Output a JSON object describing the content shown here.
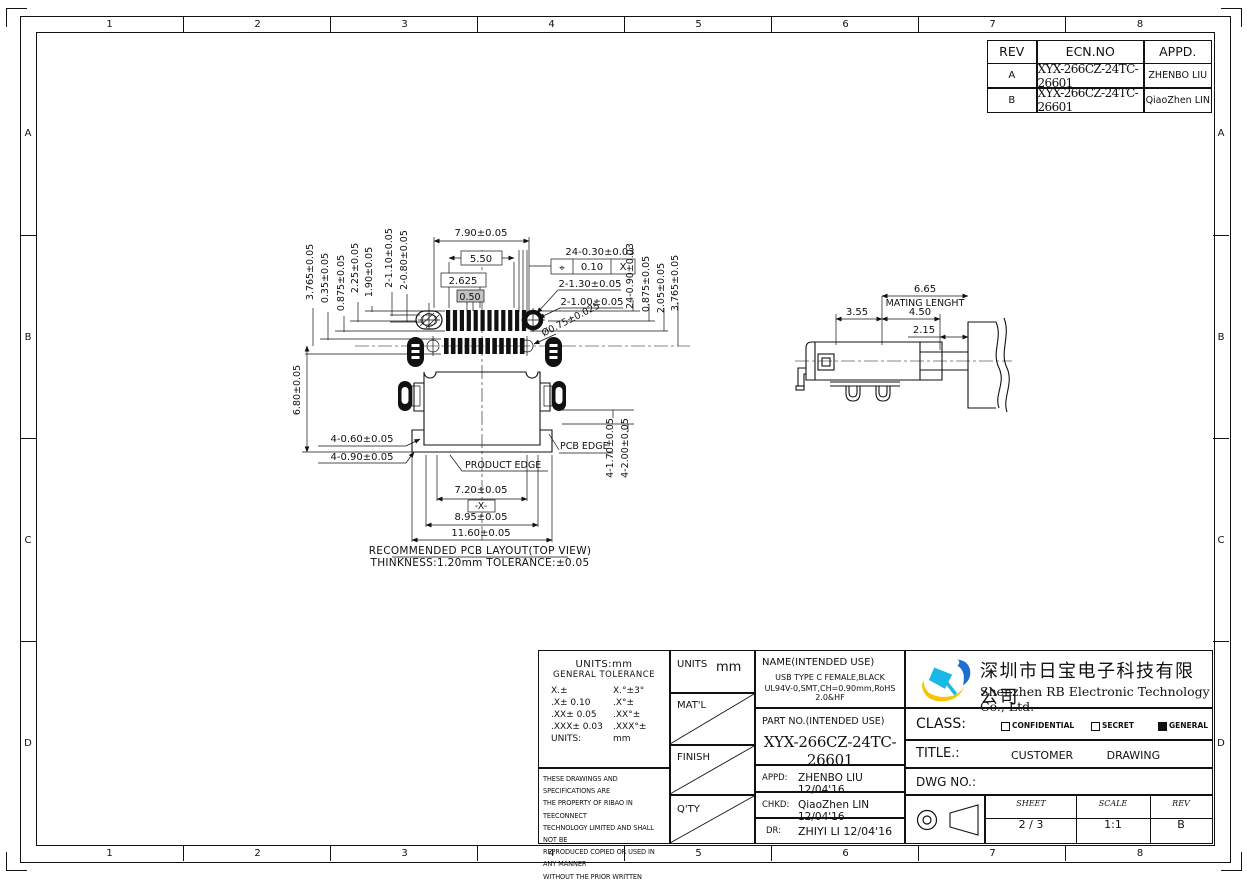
{
  "colors": {
    "line": "#111111",
    "shade_box": "#c3c3c3",
    "logo_yellow": "#f6c400",
    "logo_blue": "#1f6fd0",
    "logo_cyan": "#19b8e8"
  },
  "border": {
    "columns": [
      "1",
      "2",
      "3",
      "4",
      "5",
      "6",
      "7",
      "8"
    ],
    "rows": [
      "A",
      "B",
      "C",
      "D"
    ]
  },
  "revision_table": {
    "headers": [
      "REV",
      "ECN.NO",
      "APPD."
    ],
    "rows": [
      {
        "rev": "A",
        "ecn": "XYX-266CZ-24TC-26601",
        "appd": "ZHENBO LIU"
      },
      {
        "rev": "B",
        "ecn": "XYX-266CZ-24TC-26601",
        "appd": "QiaoZhen LIN"
      }
    ]
  },
  "pcb": {
    "dim_790": "7.90±0.05",
    "dim_550": "5.50",
    "dim_2625": "2.625",
    "dim_050": "0.50",
    "dim_24_030": "24-0.30±0.03",
    "fcf_symbol": "⌖",
    "fcf_tol": "0.10",
    "fcf_datum": "X",
    "dim_2_130": "2-1.30±0.05",
    "dim_2_100": "2-1.00±0.05",
    "dim_dia075": "Ø0.75±0.025",
    "left_dims": [
      "3.765±0.05",
      "0.35±0.05",
      "0.875±0.05",
      "2.25±0.05",
      "1.90±0.05",
      "2-1.10±0.05",
      "2-0.80±0.05"
    ],
    "dim_680": "6.80±0.05",
    "right_dims": [
      "24-0.90±0.03",
      "0.875±0.05",
      "2.05±0.05",
      "3.765±0.05"
    ],
    "dim_4_060": "4-0.60±0.05",
    "dim_4_090": "4-0.90±0.05",
    "dim_4_170": "4-1.70±0.05",
    "dim_4_200": "4-2.00±0.05",
    "product_edge": "PRODUCT EDGE",
    "pcb_edge": "PCB EDGE",
    "dim_720": "7.20±0.05",
    "datum_x": "-X-",
    "dim_895": "8.95±0.05",
    "dim_1160": "11.60±0.05",
    "caption1": "RECOMMENDED PCB LAYOUT(TOP VIEW)",
    "caption2": "THINKNESS:1.20mm TOLERANCE:±0.05"
  },
  "side": {
    "dim_665": "6.65",
    "mating": "MATING LENGHT",
    "dim_355": "3.55",
    "dim_450": "4.50",
    "dim_215": "2.15"
  },
  "title_block": {
    "tolerance": {
      "title1": "UNITS:mm",
      "title2": "GENERAL TOLERANCE",
      "rows": [
        [
          "X.±",
          "X.°±3°"
        ],
        [
          ".X± 0.10",
          ".X°±"
        ],
        [
          ".XX± 0.05",
          ".XX°±"
        ],
        [
          ".XXX± 0.03",
          ".XXX°±"
        ],
        [
          "UNITS:",
          "mm"
        ]
      ]
    },
    "legal": [
      "THESE DRAWINGS AND SPECIFICATIONS ARE",
      "THE PROPERTY OF RIBAO IN TEECONNECT",
      "TECHNOLOGY LIMITED AND SHALL NOT BE",
      "REPRODUCED COPIED OR USED IN ANY MANNER",
      "WITHOUT THE PRIOR WRITTEN CONSENT OF",
      "XINYEXING INTERCONNETEC HNOLGY LIMITEDCT"
    ],
    "units_label": "UNITS",
    "units_value": "mm",
    "matl_label": "MAT'L",
    "finish_label": "FINISH",
    "qty_label": "Q'TY",
    "name_label": "NAME(INTENDED USE)",
    "name_line1": "USB TYPE C FEMALE,BLACK",
    "name_line2": "UL94V-0,SMT,CH=0.90mm,RoHS 2.0&HF",
    "part_label": "PART NO.(INTENDED USE)",
    "part_no": "XYX-266CZ-24TC-26601",
    "appd_label": "APPD:",
    "appd_value": "ZHENBO LIU 12/04'16",
    "chkd_label": "CHKD:",
    "chkd_value": "QiaoZhen LIN 12/04'16",
    "dr_label": "DR:",
    "dr_value": "ZHIYI LI 12/04'16",
    "company_cn": "深圳市日宝电子科技有限公司",
    "company_en": "Shenzhen RB Electronic Technology Co., Ltd.",
    "class_label": "CLASS:",
    "class_options": [
      {
        "label": "CONFIDENTIAL",
        "checked": false
      },
      {
        "label": "SECRET",
        "checked": false
      },
      {
        "label": "GENERAL",
        "checked": true
      }
    ],
    "title_label": "TITLE.:",
    "title_value": "CUSTOMER DRAWING",
    "dwg_label": "DWG NO.:",
    "sheet_label": "SHEET",
    "sheet_value": "2 / 3",
    "scale_label": "SCALE",
    "scale_value": "1:1",
    "rev_label": "REV",
    "rev_value": "B"
  }
}
